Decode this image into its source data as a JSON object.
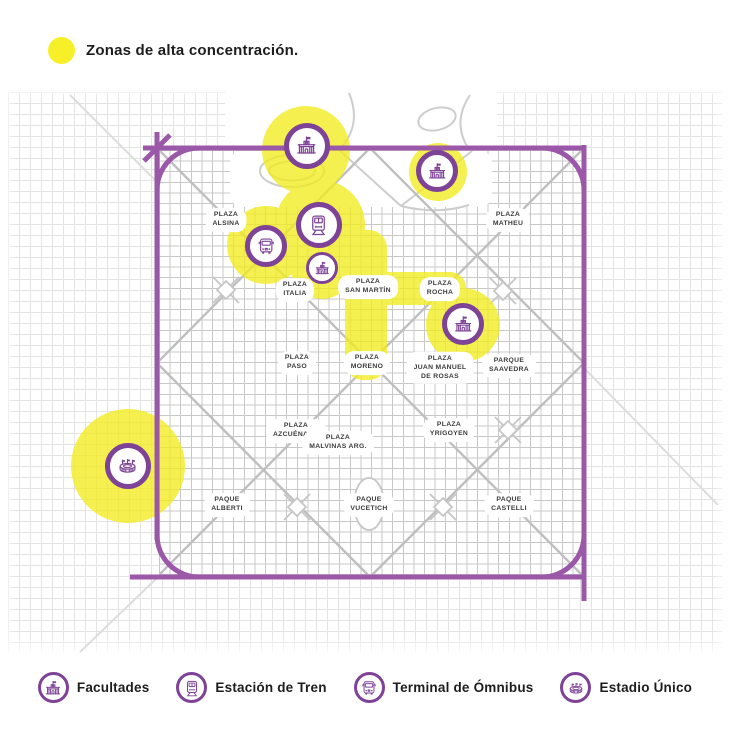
{
  "colors": {
    "zone_yellow": "#F2EC1E",
    "legend_dot_yellow": "#F7EF27",
    "boundary_purple": "#9C58A8",
    "marker_purple": "#7E4397",
    "text_dark": "#1D1D1D"
  },
  "top_legend": {
    "label": "Zonas de alta concentración."
  },
  "map": {
    "plazas": [
      {
        "name": "PLAZA\nALSINA",
        "x": 226,
        "y": 220
      },
      {
        "name": "PLAZA\nMATHEU",
        "x": 508,
        "y": 220
      },
      {
        "name": "PLAZA\nITALIA",
        "x": 295,
        "y": 290
      },
      {
        "name": "PLAZA\nSAN MARTÍN",
        "x": 368,
        "y": 287
      },
      {
        "name": "PLAZA\nROCHA",
        "x": 440,
        "y": 289
      },
      {
        "name": "PLAZA\nPASO",
        "x": 297,
        "y": 363
      },
      {
        "name": "PLAZA\nMORENO",
        "x": 367,
        "y": 363
      },
      {
        "name": "PLAZA\nJUAN MANUEL\nDE ROSAS",
        "x": 440,
        "y": 368
      },
      {
        "name": "PARQUE\nSAAVEDRA",
        "x": 509,
        "y": 366
      },
      {
        "name": "PLAZA\nAZCUÉNAGA",
        "x": 296,
        "y": 431
      },
      {
        "name": "PLAZA\nMALVINAS ARG.",
        "x": 338,
        "y": 443
      },
      {
        "name": "PLAZA\nYRIGOYEN",
        "x": 449,
        "y": 430
      },
      {
        "name": "PAQUE\nALBERTI",
        "x": 227,
        "y": 505
      },
      {
        "name": "PAQUE\nVUCETICH",
        "x": 369,
        "y": 505
      },
      {
        "name": "PAQUE\nCASTELLI",
        "x": 509,
        "y": 505
      }
    ],
    "markers": [
      {
        "type": "facultad",
        "x": 307,
        "y": 146,
        "size": 46
      },
      {
        "type": "facultad",
        "x": 437,
        "y": 171,
        "size": 42
      },
      {
        "type": "tren",
        "x": 319,
        "y": 225,
        "size": 46
      },
      {
        "type": "omnibus",
        "x": 266,
        "y": 246,
        "size": 42
      },
      {
        "type": "facultad",
        "x": 322,
        "y": 268,
        "size": 32
      },
      {
        "type": "facultad",
        "x": 463,
        "y": 324,
        "size": 42
      },
      {
        "type": "estadio",
        "x": 128,
        "y": 466,
        "size": 46
      }
    ],
    "zones": {
      "circles": [
        {
          "cx": 306,
          "cy": 150,
          "r": 44
        },
        {
          "cx": 438,
          "cy": 172,
          "r": 29
        },
        {
          "cx": 266,
          "cy": 245,
          "r": 39
        },
        {
          "cx": 320,
          "cy": 225,
          "r": 45
        },
        {
          "cx": 322,
          "cy": 268,
          "r": 31
        },
        {
          "cx": 463,
          "cy": 325,
          "r": 37
        },
        {
          "cx": 128,
          "cy": 466,
          "r": 57
        }
      ],
      "bands": [
        {
          "x": 345,
          "y": 230,
          "w": 42,
          "h": 150,
          "rx": 18
        },
        {
          "x": 366,
          "y": 272,
          "w": 100,
          "h": 33,
          "rx": 16
        }
      ]
    }
  },
  "bottom_legend": {
    "items": [
      {
        "icon": "facultades-icon",
        "type": "facultad",
        "label": "Facultades"
      },
      {
        "icon": "estacion-tren-icon",
        "type": "tren",
        "label": "Estación de Tren"
      },
      {
        "icon": "terminal-omnibus-icon",
        "type": "omnibus",
        "label": "Terminal de Ómnibus"
      },
      {
        "icon": "estadio-unico-icon",
        "type": "estadio",
        "label": "Estadio Único"
      }
    ]
  }
}
